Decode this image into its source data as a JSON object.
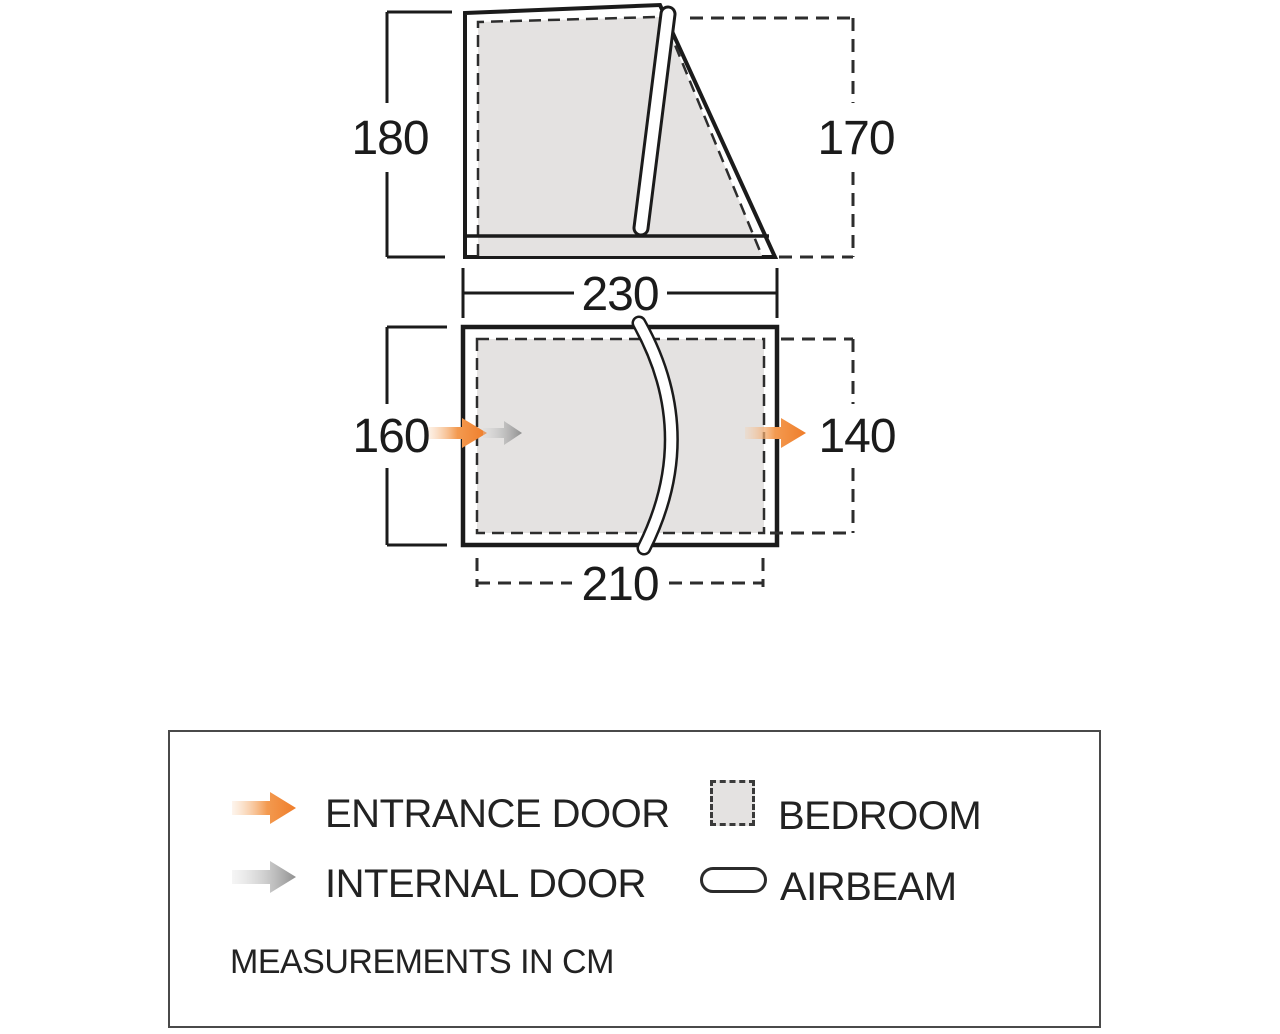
{
  "side_view": {
    "height_left": "180",
    "height_right": "170",
    "width": "230"
  },
  "floor_plan": {
    "depth": "160",
    "bedroom_depth": "140",
    "bedroom_width": "210"
  },
  "legend": {
    "entrance_door": "ENTRANCE DOOR",
    "internal_door": "INTERNAL DOOR",
    "bedroom": "BEDROOM",
    "airbeam": "AIRBEAM",
    "note": "MEASUREMENTS IN CM"
  },
  "colors": {
    "accent_orange": "#F0802F",
    "internal_grey": "#979797",
    "bedroom_fill": "#E4E2E1",
    "outline": "#1b1b1b"
  }
}
